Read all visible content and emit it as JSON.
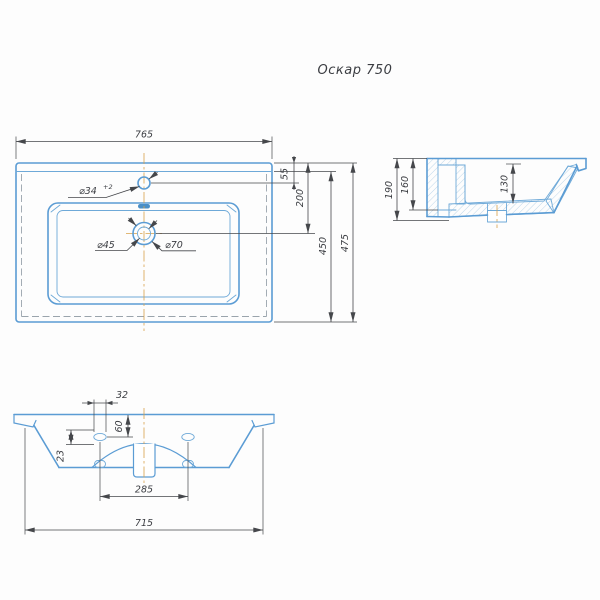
{
  "title": "Оскар 750",
  "colors": {
    "line_blue": "#5b9cd4",
    "line_blue_light": "#6ea9d8",
    "hatch_blue": "#aecde5",
    "dim_gray": "#45474b",
    "centerline_orange": "#d8a14a",
    "dashed_gray": "#9aa4ac",
    "slot_fill": "#4a8fc7",
    "text_color": "#3b3d42",
    "bg": "#fdfdfd"
  },
  "plan_view": {
    "dims": {
      "width": "765",
      "faucet_offset": "55",
      "drain_offset": "200",
      "depth_body": "450",
      "depth_total": "475"
    },
    "labels": {
      "faucet_hole": "⌀34",
      "faucet_tol": "+2",
      "drain_inner": "⌀45",
      "drain_outer": "⌀70"
    }
  },
  "side_view": {
    "dims": {
      "height_total": "190",
      "height_inner": "160",
      "basin_depth": "130"
    }
  },
  "bottom_view": {
    "dims": {
      "hole_width": "32",
      "hole_top_offset": "60",
      "hole_side_offset": "23",
      "mount_span": "285",
      "base_width": "715"
    }
  }
}
